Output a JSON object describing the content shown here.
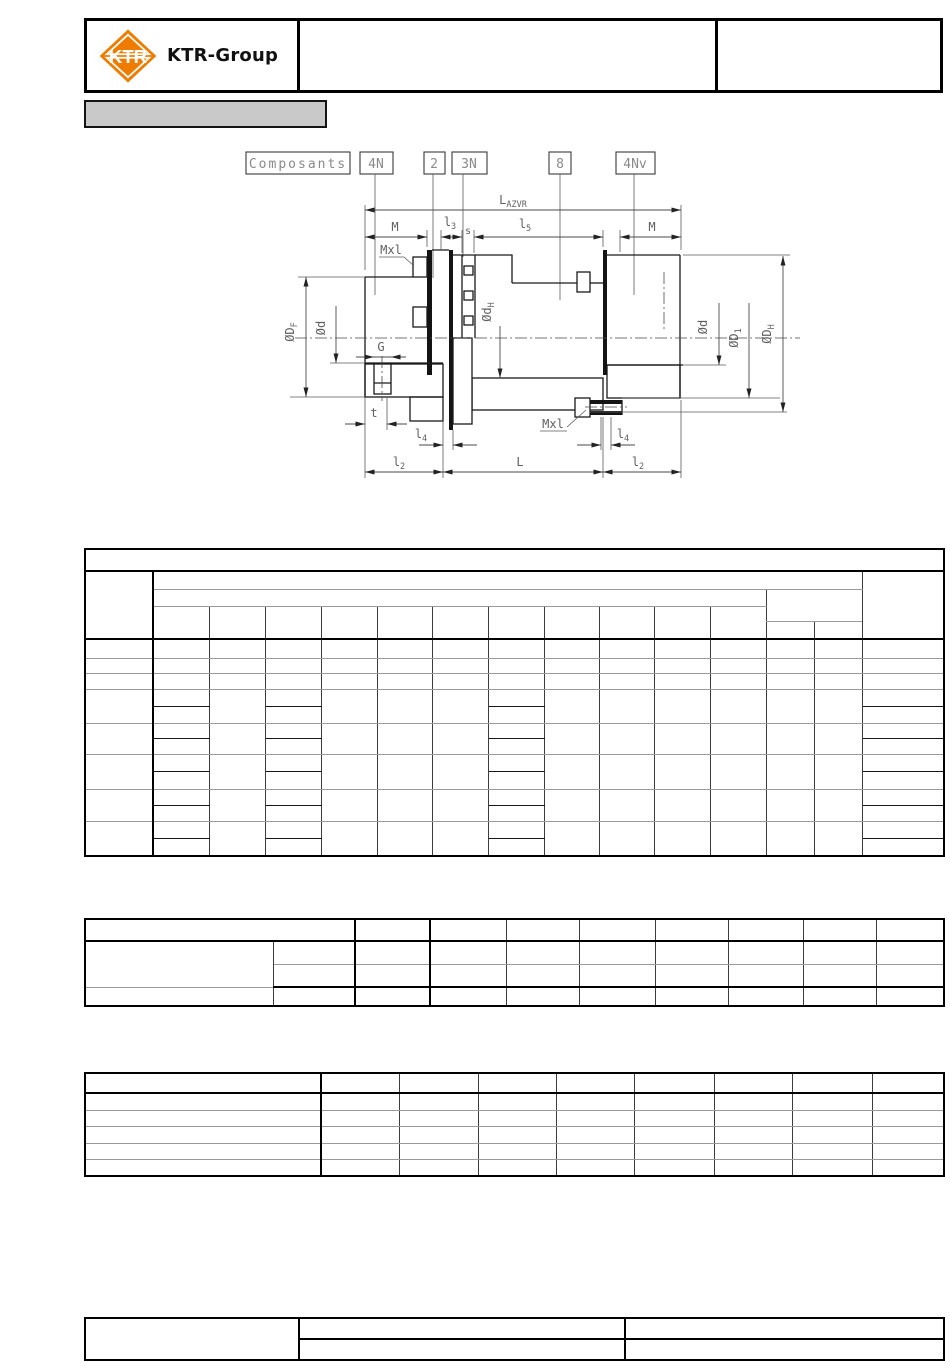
{
  "header": {
    "logo_text": "KTR",
    "brand": "KTR-Group"
  },
  "drawing": {
    "components_label": "Composants",
    "part_labels": {
      "p4n": "4N",
      "p2": "2",
      "p3n": "3N",
      "p8": "8",
      "p4nv": "4Nv"
    },
    "dims": {
      "l_azvr": {
        "main": "L",
        "sub": "AZVR"
      },
      "m": "M",
      "l3": {
        "main": "l",
        "sub": "3"
      },
      "s": "s",
      "l5": {
        "main": "l",
        "sub": "5"
      },
      "mxl": "Mxl",
      "d_f": {
        "main": "ØD",
        "sub": "F"
      },
      "d_small": "Ød",
      "g": "G",
      "t": "t",
      "l4": {
        "main": "l",
        "sub": "4"
      },
      "l2": {
        "main": "l",
        "sub": "2"
      },
      "l_total": "L",
      "d_h_bore": {
        "main": "Ød",
        "sub": "H"
      },
      "d_1": {
        "main": "ØD",
        "sub": "1"
      },
      "d_h_outer": {
        "main": "ØD",
        "sub": "H"
      }
    }
  },
  "colors": {
    "ktr_orange": "#EF7C00",
    "annotation_fill": "#c9c9c9",
    "line_dark": "#1a1a1a",
    "line_gray": "#5a5a5a",
    "hatch_gray": "#b5b5b5"
  }
}
